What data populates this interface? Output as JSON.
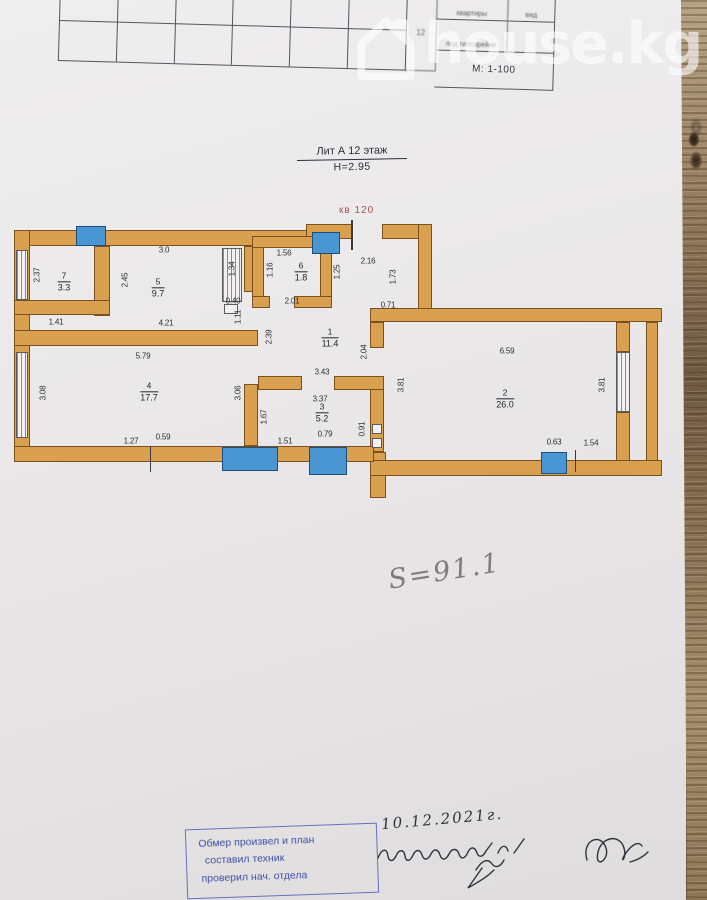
{
  "watermark": {
    "text": "house.kg"
  },
  "title_block": {
    "cell_num": "12",
    "col_kvartiry": "квартиры",
    "col_vid": "вид",
    "row_pod": "под гипсорейки",
    "scale": "М: 1-100"
  },
  "plan": {
    "lit": "Лит А 12 этаж",
    "height": "Н=2.95",
    "flat": "кв 120",
    "rooms": [
      {
        "num": "7",
        "area": "3.3"
      },
      {
        "num": "5",
        "area": "9.7"
      },
      {
        "num": "6",
        "area": "1.8"
      },
      {
        "num": "1",
        "area": "11.4"
      },
      {
        "num": "4",
        "area": "17.7"
      },
      {
        "num": "3",
        "area": "5.2"
      },
      {
        "num": "2",
        "area": "26.0"
      }
    ],
    "dims": {
      "r7_w": "2.37",
      "r7_s": "1.41",
      "k_n": "3.0",
      "k_w": "2.45",
      "k_s": "4.21",
      "k_e": "1.34",
      "m_040": "0.40",
      "m_111": "1.11",
      "wc_n": "1.56",
      "wc_w": "1.16",
      "wc_s": "2.01",
      "wc_e": "1.25",
      "e_n": "2.16",
      "e_e": "1.73",
      "e_s": "0.71",
      "c_w": "2.39",
      "c_e": "2.04",
      "c_s": "3.43",
      "r4_n": "5.79",
      "r4_w": "3.08",
      "r4_e": "3.06",
      "r4_s1": "1.27",
      "r4_s2": "0.59",
      "r3_n": "3.37",
      "r3_w": "1.67",
      "r3_s1": "1.51",
      "r3_s2": "0.79",
      "r3_e": "0.91",
      "r2_n": "6.59",
      "r2_w": "3.81",
      "r2_e": "3.81",
      "r2_s1": "0.63",
      "r2_s2": "1.54"
    }
  },
  "notes": {
    "area_total": "S=91.1",
    "date": "10.12.2021г."
  },
  "stamp": {
    "line1": "Обмер произвел и план",
    "line2": "составил техник",
    "line3": "проверил нач. отдела"
  },
  "colors": {
    "wall": "#d9a050",
    "window": "#4a96d2",
    "stamp_blue": "#4050a8",
    "flat_red": "#b0504e"
  }
}
